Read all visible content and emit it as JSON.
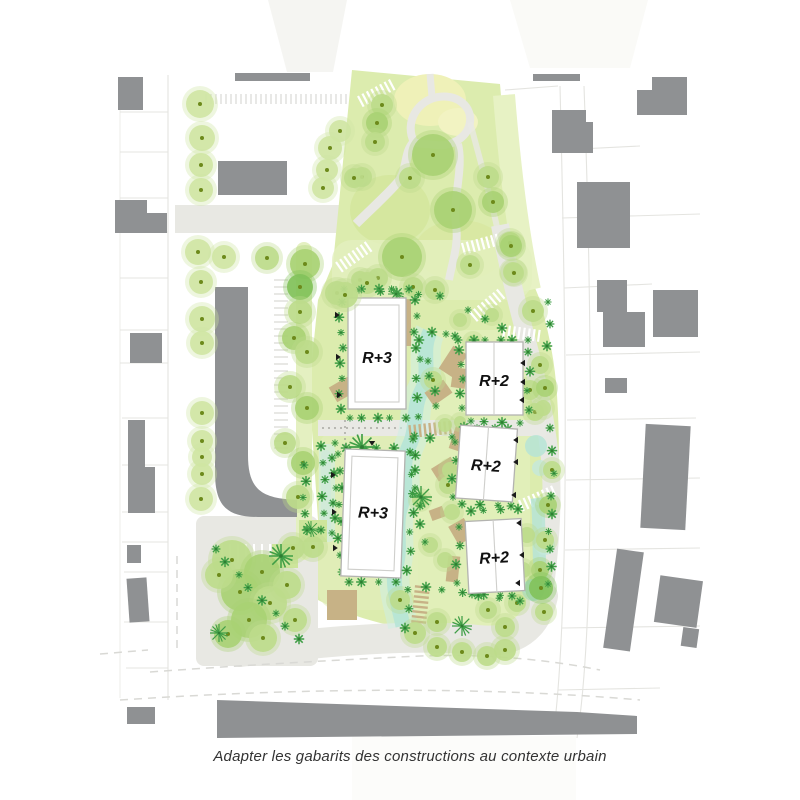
{
  "plan": {
    "buildings": [
      {
        "id": "r3-north",
        "label": "R+3"
      },
      {
        "id": "r3-south",
        "label": "R+3"
      },
      {
        "id": "r2-north",
        "label": "R+2"
      },
      {
        "id": "r2-middle",
        "label": "R+2"
      },
      {
        "id": "r2-south",
        "label": "R+2"
      }
    ],
    "caption": "Adapter les gabarits des constructions au contexte urbain",
    "colors": {
      "context_building": "#8f9193",
      "park_green": "#dcecae",
      "tree_green": "#a9d173",
      "shrub_green": "#3f9e46",
      "swale_teal": "#b6e4d6",
      "tan": "#c7b286",
      "road": "#e8e8e3",
      "label_text": "#111111",
      "caption_text": "#333333"
    }
  }
}
